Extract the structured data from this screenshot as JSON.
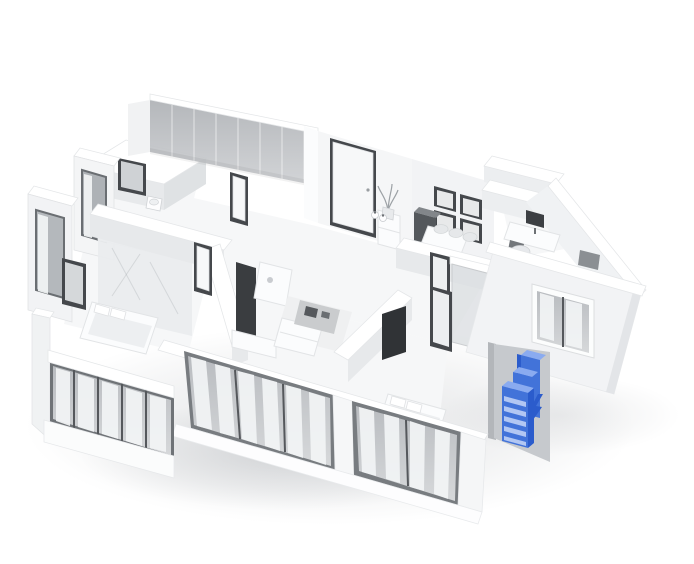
{
  "scene": {
    "type": "3d-apartment-floorplan-render",
    "background": "#ffffff",
    "colors": {
      "accent-blue": "#4273d9",
      "accent-blue-light": "#8aabf0",
      "accent-blue-pale": "#b9ccf5",
      "accent-blue-dark": "#2b5ccc",
      "wall-top": "#ffffff",
      "wall-face": "#eceef0",
      "wall-face-dark": "#d7dadd",
      "glass-gray": "#bcbfc3",
      "frame-dark": "#45484c",
      "floor-gray": "#f6f7f8",
      "shadow-gray": "#8d939a"
    },
    "highlight": {
      "item": "entrance-cabinet",
      "marker": "lightning-bolt-icon"
    }
  }
}
